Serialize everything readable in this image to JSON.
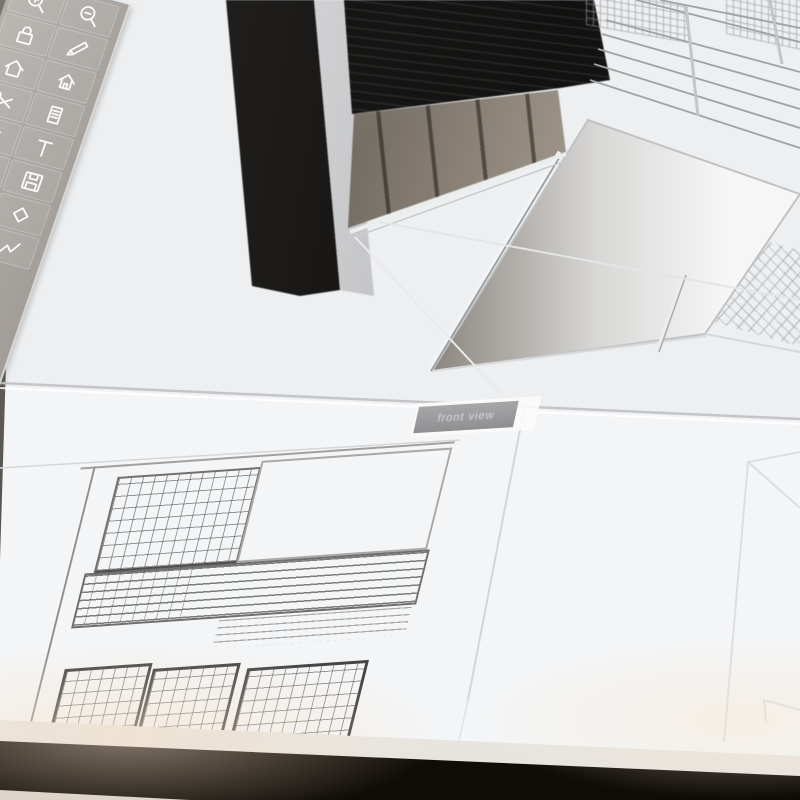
{
  "viewports": {
    "front_view_label": "front view"
  },
  "toolbar": {
    "rows": [
      [
        "zoom-in",
        "zoom-out"
      ],
      [
        "lock",
        "pencil"
      ],
      [
        "home",
        "house"
      ],
      [
        "scissors",
        "document"
      ],
      [
        "settings",
        "text"
      ],
      [
        null,
        "save"
      ],
      [
        null,
        "shape"
      ],
      [
        null,
        "polyline"
      ]
    ]
  },
  "colors": {
    "canvas": "#edeff1",
    "sheet": "#f4f5f6",
    "toolbar_a": "#b5b1ad",
    "toolbar_b": "#9e9995",
    "building_dark": "#171615",
    "glass": "#8f8779",
    "bezel": "#1d1711",
    "label_bg": "#9d9da0",
    "label_text": "#c9c9cc",
    "drawing_ink": "#4a4a4a",
    "guide_line": "#c6c8cb"
  }
}
